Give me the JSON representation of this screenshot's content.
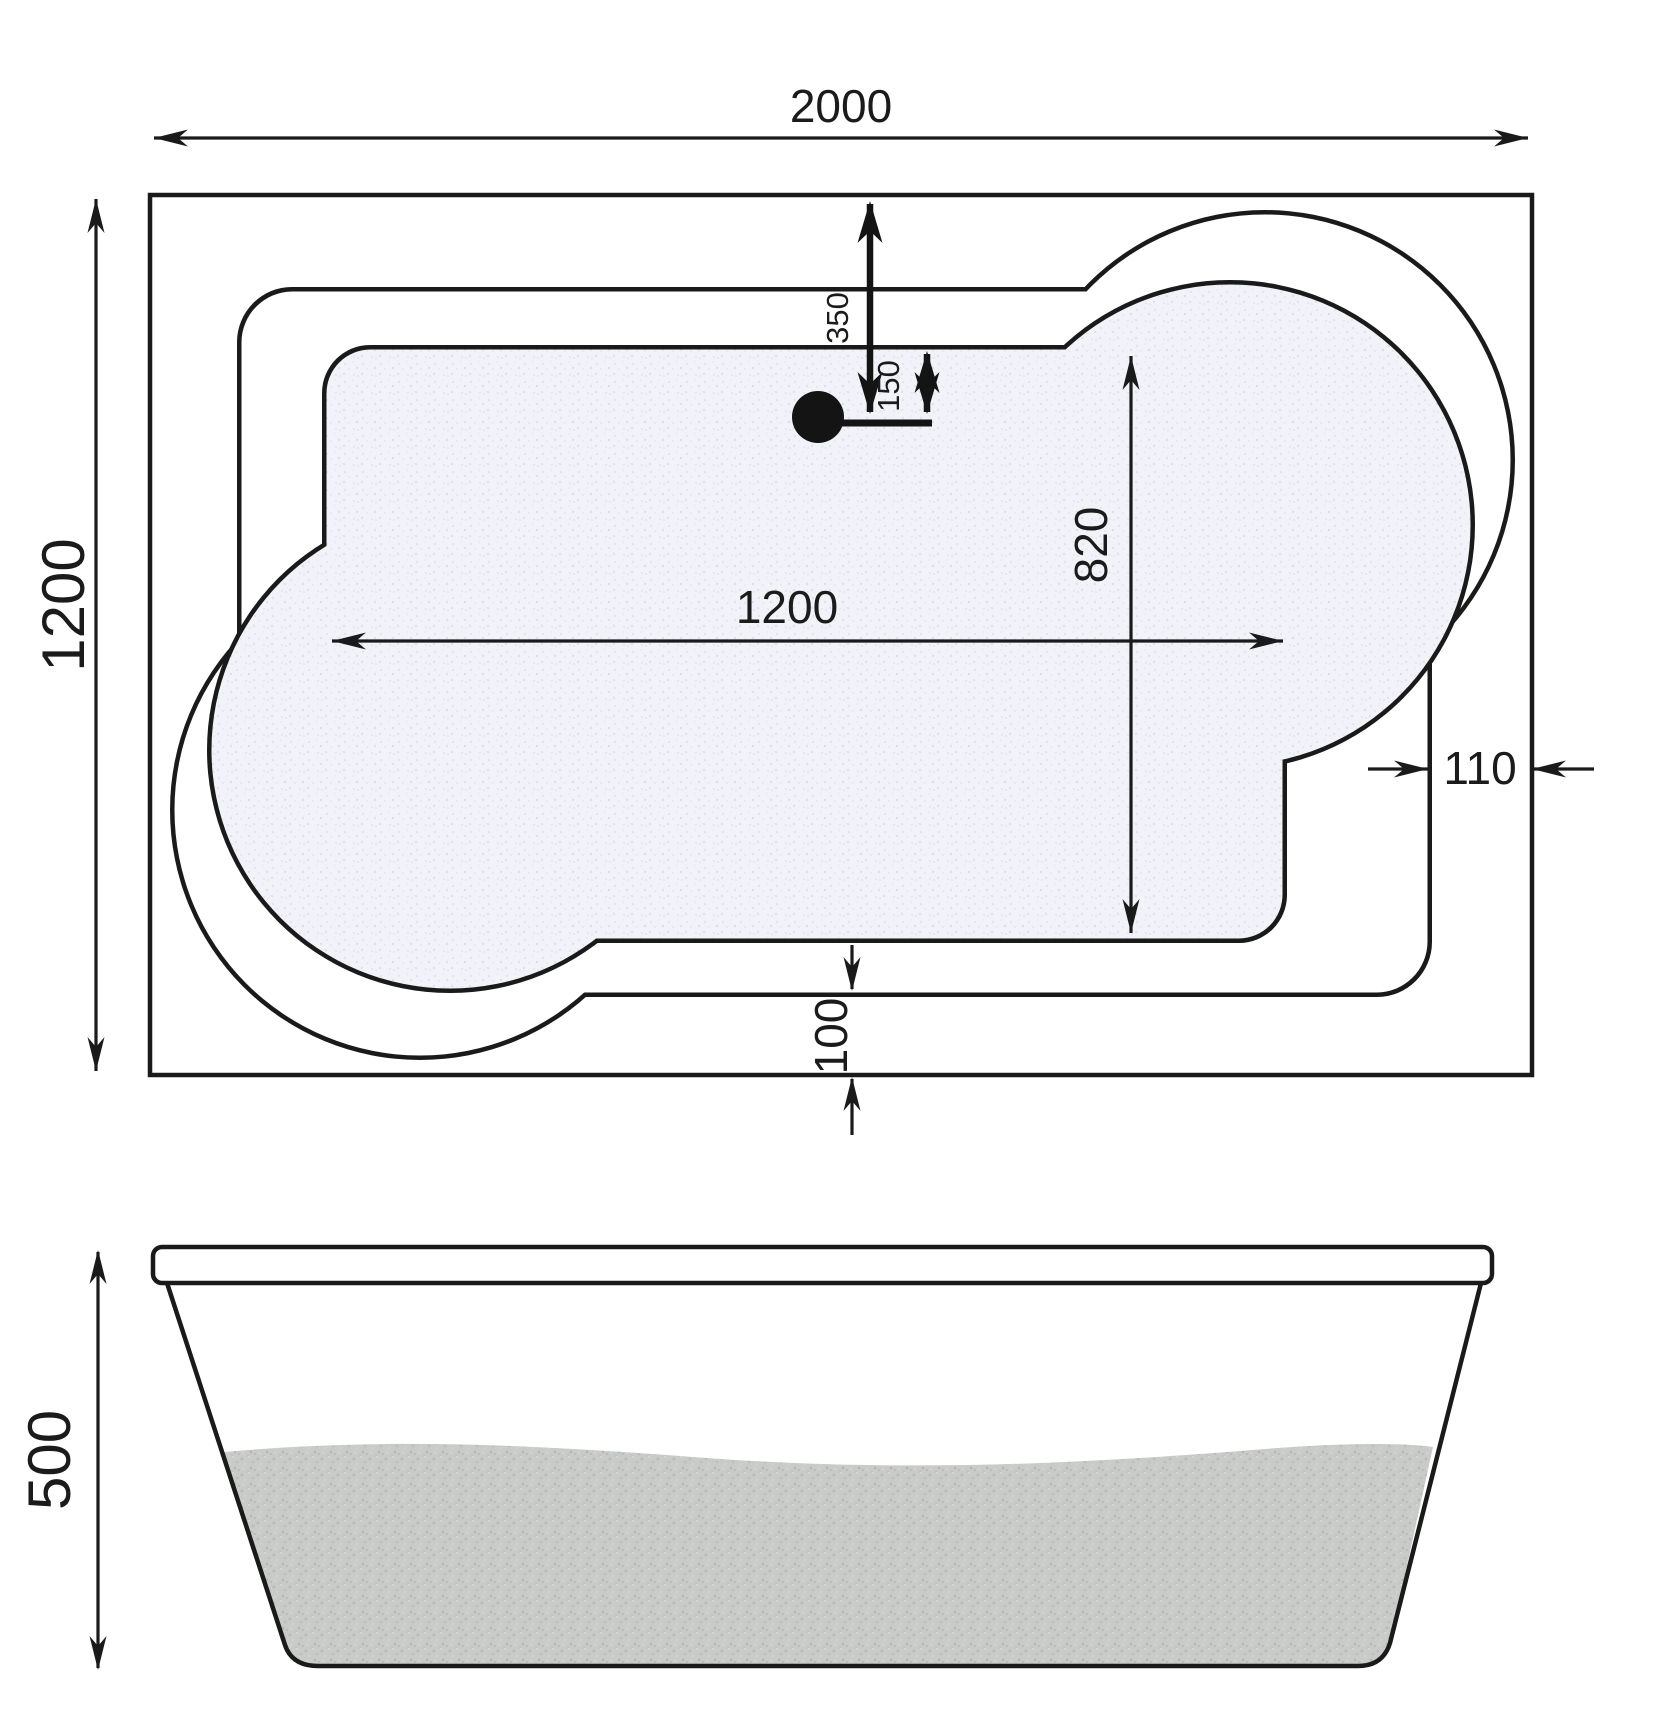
{
  "drawing": {
    "top_view": {
      "overall_width": "2000",
      "overall_depth": "1200",
      "basin_length": "1200",
      "basin_width": "820",
      "drain_offset_from_edge": "350",
      "drain_offset_from_basin": "150",
      "rim_gap_right": "110",
      "rim_gap_bottom": "100"
    },
    "side_view": {
      "height": "500"
    },
    "colors": {
      "line": "#1a1a1a",
      "basin_fill": "#f2f3f8",
      "water_fill": "#c9cbc9",
      "background": "#ffffff"
    }
  }
}
